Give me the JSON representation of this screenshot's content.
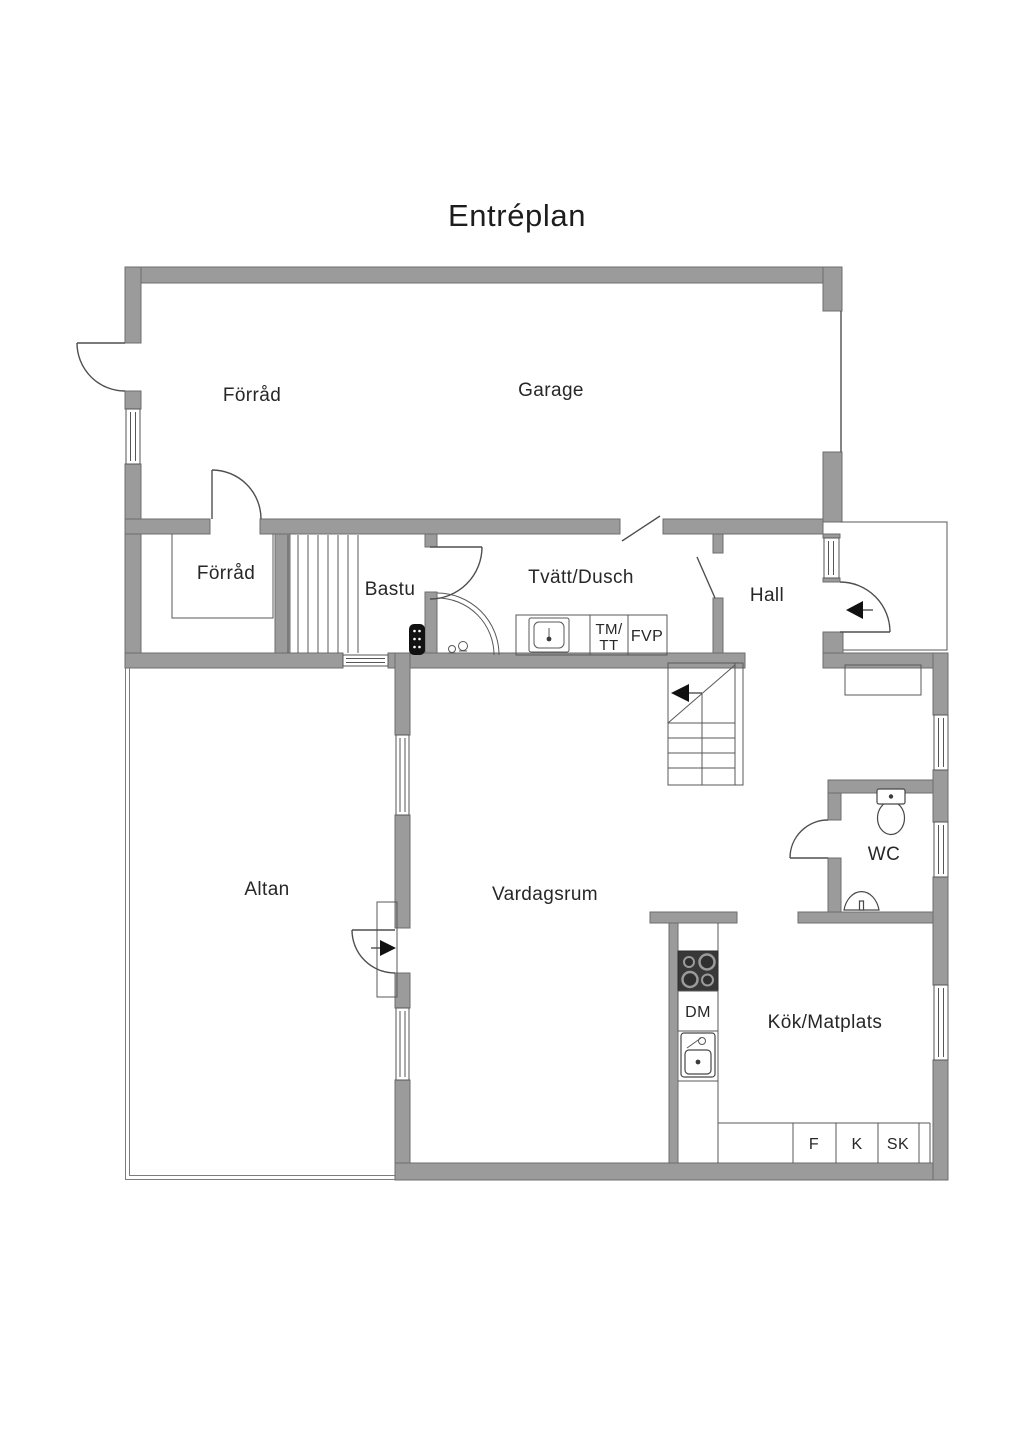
{
  "title": "Entréplan",
  "rooms": {
    "forrad_large": "Förråd",
    "garage": "Garage",
    "forrad_small": "Förråd",
    "bastu": "Bastu",
    "tvatt_dusch": "Tvätt/Dusch",
    "hall": "Hall",
    "altan": "Altan",
    "vardagsrum": "Vardagsrum",
    "wc": "WC",
    "kok_matplats": "Kök/Matplats"
  },
  "appliances": {
    "dm": "DM",
    "tm_line1": "TM/",
    "tm_line2": "TT",
    "fvp": "FVP",
    "f": "F",
    "k": "K",
    "sk": "SK"
  },
  "colors": {
    "background": "#ffffff",
    "wall_fill": "#9b9b9b",
    "wall_stroke": "#6e6e6e",
    "line": "#4f4f4f",
    "text": "#272727",
    "stove_dark": "#383838",
    "heater_black": "#111111"
  }
}
